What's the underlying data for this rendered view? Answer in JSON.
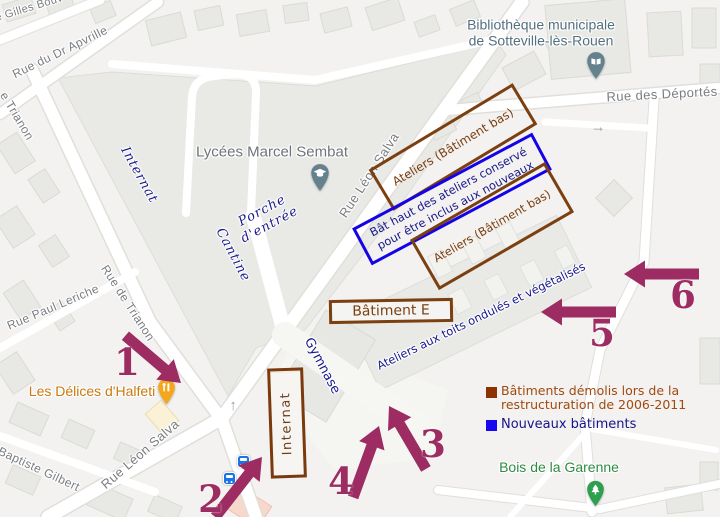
{
  "streets": {
    "gilles": "ue Gilles Bouv",
    "apvrille": "Rue du Dr Apvrille",
    "trianon_top": "e Trianon",
    "trianon_mid": "Rue de Trianon",
    "paul_leriche": "Rue Paul Leriche",
    "baptiste_gilbert": "Baptiste Gilbert",
    "leon_salva_upper": "Rue Léon Salva",
    "leon_salva_lower": "Rue Léon Salva",
    "deportes": "Rue des Déportés"
  },
  "pois": {
    "library": {
      "line1": "Bibliothèque municipale",
      "line2": "de Sotteville-lès-Rouen",
      "color": "#54707F",
      "icon": "book-pin"
    },
    "school": {
      "name": "Lycées Marcel Sembat",
      "color": "#6F7479",
      "icon": "graduation-cap-pin"
    },
    "restaurant": {
      "name": "Les Délices d'Halfeti",
      "color": "#C9790F",
      "icon": "restaurant-pin"
    },
    "park": {
      "name": "Bois de la Garenne",
      "color": "#2E8B44",
      "icon": "tree-pin"
    }
  },
  "map_notes": {
    "internat_script": "Internat",
    "porche_line1": "Porche",
    "porche_line2": "d'entrée",
    "cantine": "Cantine",
    "gymnase": "Gymnase",
    "ateliers_toits": "Ateliers aux toits ondulés et végétalisés"
  },
  "annotations": {
    "ateliers_box1": "Ateliers (Bâtiment bas)",
    "ateliers_box2": "Ateliers (Bâtiment bas)",
    "bat_haut_line1": "Bât haut des ateliers conservé",
    "bat_haut_line2": "pour être inclus aux nouveaux",
    "batiment_e": "Bâtiment E",
    "internat_box": "Internat",
    "colors": {
      "demolished_outline": "#7B3F10",
      "new_outline": "#1503E8",
      "navy_text": "#18188C",
      "arrow": "#9C2C62"
    }
  },
  "legend": {
    "demolished_label": "Bâtiments démolis lors de la restructuration de 2006-2011",
    "demolished_color": "#8B3200",
    "demolished_text_color": "#A04A10",
    "new_label": "Nouveaux bâtiments",
    "new_color": "#1708F0"
  },
  "arrows": {
    "a1": "1",
    "a2": "2",
    "a3": "3",
    "a4": "4",
    "a5": "5",
    "a6": "6"
  }
}
